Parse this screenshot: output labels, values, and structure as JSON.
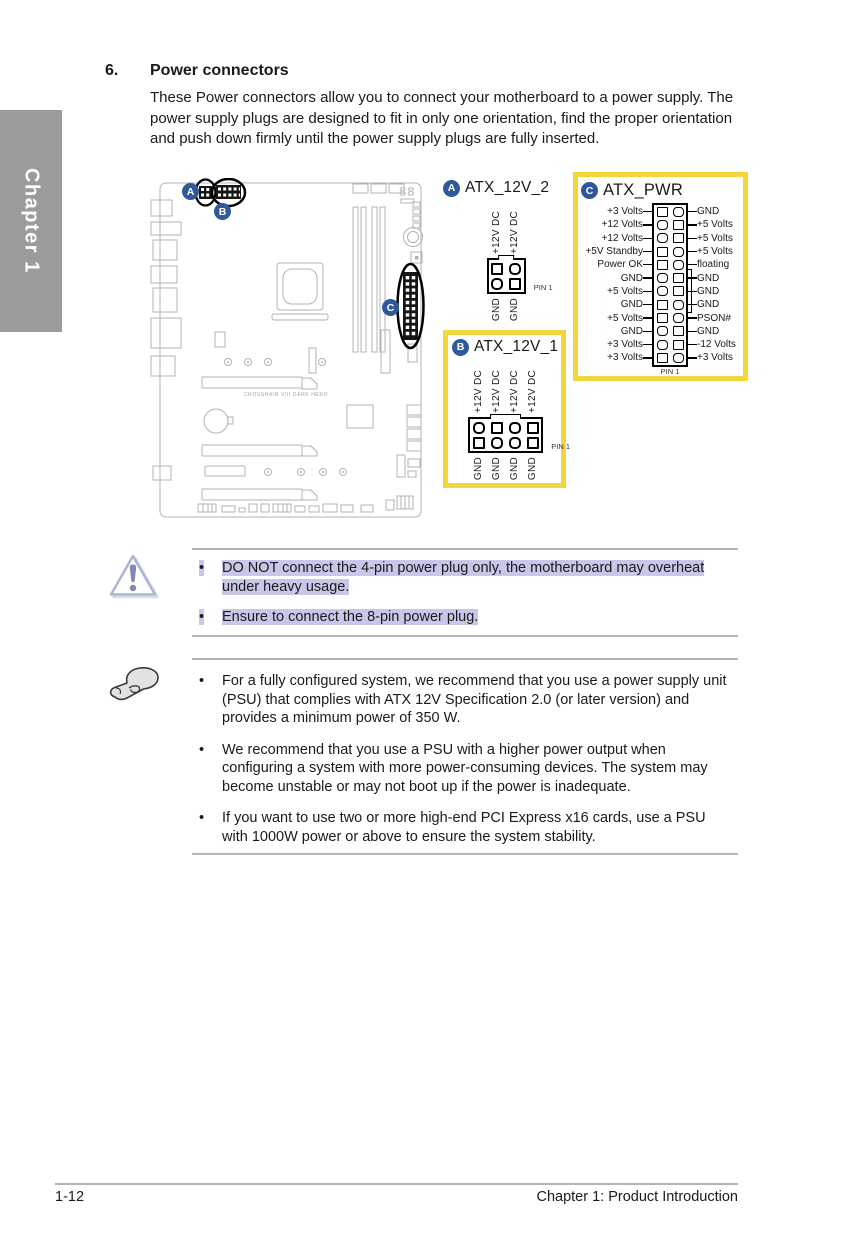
{
  "page": {
    "chapter_tab": "Chapter 1",
    "footer_left": "1-12",
    "footer_right": "Chapter 1: Product Introduction"
  },
  "section": {
    "number": "6.",
    "title": "Power connectors",
    "intro": "These Power connectors allow you to connect your motherboard to a power supply. The power supply plugs are designed to fit in only one orientation, find the proper orientation and push down firmly until the power supply plugs are fully inserted."
  },
  "board": {
    "label": "CROSSHAIR VIII DARK HERO",
    "display": "88"
  },
  "connectors": {
    "atx_12v_2": {
      "badge": "A",
      "name": "ATX_12V_2",
      "top_pins": [
        "+12V DC",
        "+12V DC"
      ],
      "bottom_pins": [
        "GND",
        "GND"
      ],
      "pin1_label": "PIN 1"
    },
    "atx_12v_1": {
      "badge": "B",
      "name": "ATX_12V_1",
      "top_pins": [
        "+12V DC",
        "+12V DC",
        "+12V DC",
        "+12V DC"
      ],
      "bottom_pins": [
        "GND",
        "GND",
        "GND",
        "GND"
      ],
      "pin1_label": "PIN 1"
    },
    "atx_pwr": {
      "badge": "C",
      "name": "ATX_PWR",
      "rows": [
        {
          "left": "+3 Volts",
          "right": "GND"
        },
        {
          "left": "+12 Volts",
          "right": "+5 Volts"
        },
        {
          "left": "+12 Volts",
          "right": "+5 Volts"
        },
        {
          "left": "+5V Standby",
          "right": "+5 Volts"
        },
        {
          "left": "Power OK",
          "right": "floating"
        },
        {
          "left": "GND",
          "right": "GND"
        },
        {
          "left": "+5 Volts",
          "right": "GND"
        },
        {
          "left": "GND",
          "right": "GND"
        },
        {
          "left": "+5 Volts",
          "right": "PSON#"
        },
        {
          "left": "GND",
          "right": "GND"
        },
        {
          "left": "+3 Volts",
          "right": "-12 Volts"
        },
        {
          "left": "+3 Volts",
          "right": "+3 Volts"
        }
      ],
      "pin1_label": "PIN 1"
    }
  },
  "warning": {
    "items": [
      "DO NOT connect the 4-pin power plug only, the motherboard may overheat under heavy usage.",
      "Ensure to connect the 8-pin power plug."
    ]
  },
  "notes": {
    "items": [
      "For a fully configured system, we recommend that you use a power supply unit (PSU) that complies with ATX 12V Specification 2.0 (or later version) and provides a minimum power of 350 W.",
      "We recommend that you use a PSU with a higher power output when configuring a system with more power-consuming devices. The system may become unstable or may not boot up if the power is inadequate.",
      "If you want to use two or more high-end PCI Express x16 cards, use a PSU with 1000W power or above to ensure the system stability."
    ]
  },
  "colors": {
    "accent_yellow": "#f2d73c",
    "badge_blue": "#30599c",
    "highlight": "#c7c8e9",
    "tab_gray": "#9b9b9b"
  }
}
